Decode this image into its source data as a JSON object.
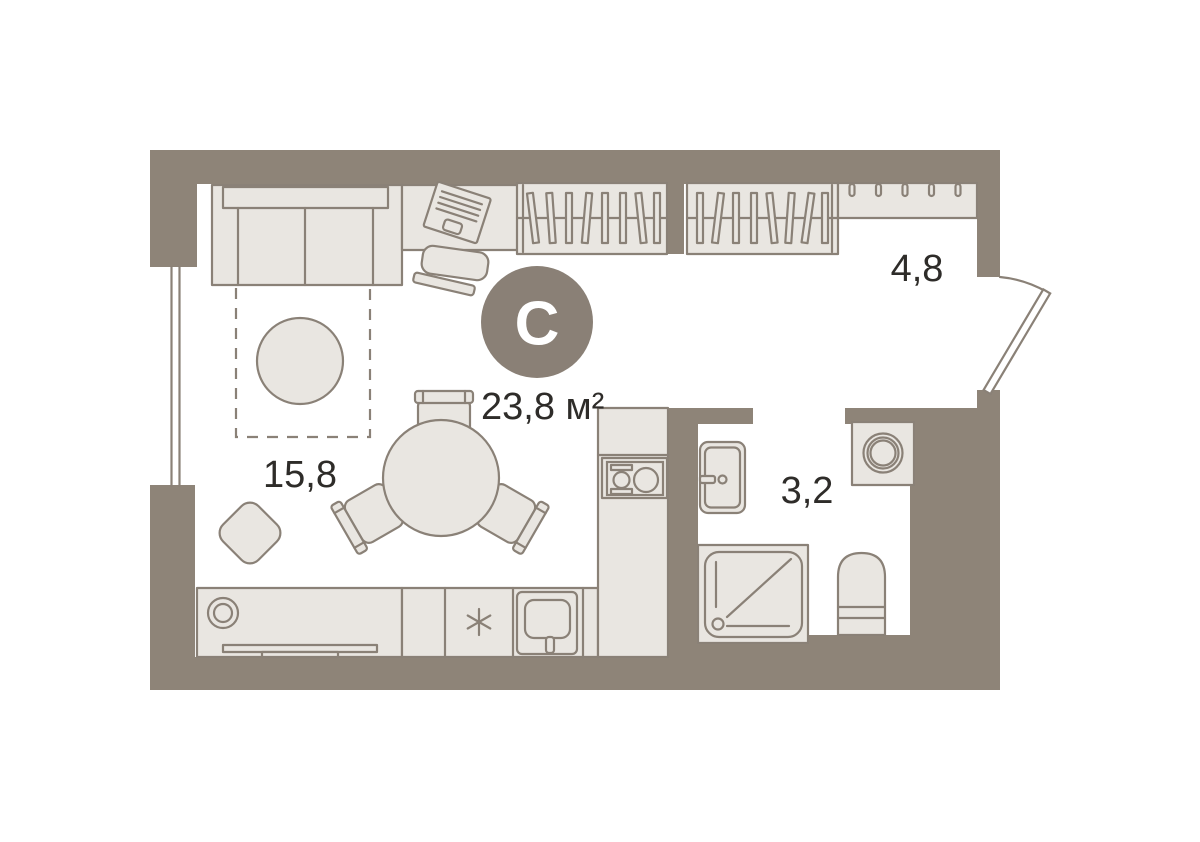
{
  "plan": {
    "badge": {
      "letter": "С",
      "color": "#8a8076"
    },
    "total_area": "23,8 м²",
    "rooms": {
      "living": {
        "name": "living-room",
        "area": "15,8"
      },
      "hall": {
        "name": "hallway",
        "area": "4,8"
      },
      "bathroom": {
        "name": "bathroom",
        "area": "3,2"
      }
    },
    "fixtures": [
      "corner-sofa",
      "sleeping-zone",
      "round-rug",
      "desk",
      "desk-chair",
      "laptop",
      "wardrobe-hangers",
      "wardrobe-hangers",
      "coat-rack-hooks",
      "dining-table",
      "dining-chairs",
      "ottoman",
      "tv-console",
      "tv",
      "fridge-snowflake",
      "kitchen-sink",
      "cooktop-two-burners",
      "bathroom-sink",
      "washing-machine",
      "shower-tray",
      "toilet",
      "entrance-door",
      "window"
    ],
    "colors": {
      "wall": "#8e8478",
      "furniture_fill": "#e9e6e1",
      "outline": "#8a8177",
      "badge": "#8a8076",
      "text": "#2e2c29",
      "background": "#ffffff"
    }
  }
}
